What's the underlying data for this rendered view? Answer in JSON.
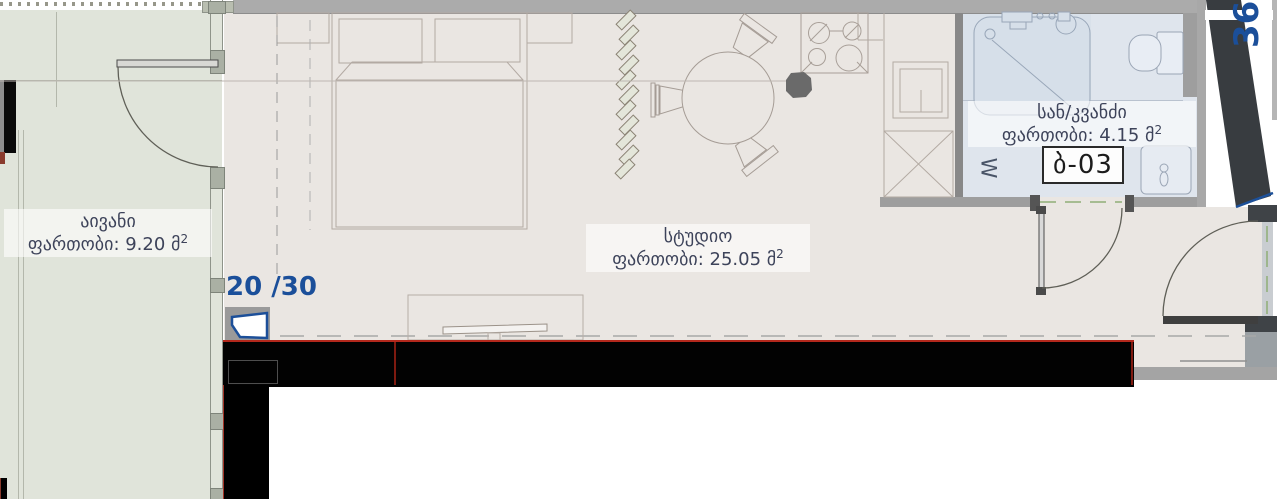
{
  "plan": {
    "balcony": {
      "name": "აივანი",
      "area": "ფართობი: 9.20 მ",
      "sup": "2"
    },
    "studio": {
      "name": "სტუდიო",
      "area": "ფართობი: 25.05 მ",
      "sup": "2"
    },
    "bathroom": {
      "name": "სან/კვანძი",
      "area": "ფართობი: 4.15 მ",
      "sup": "2"
    },
    "unit_number": "ბ-03",
    "window_ratio": "20 /30",
    "wall_dimension": "360",
    "washer_symbol": "W",
    "colors": {
      "accent_blue": "#1b4f9a",
      "wall_dark": "#3c4043",
      "wall_gray": "#ababab",
      "floor_studio": "#eae6e2",
      "floor_balcony": "#e0e4da",
      "floor_bathroom": "#dfe5ed",
      "highlight_red": "#b3281c",
      "label_text": "#3d435a"
    }
  }
}
